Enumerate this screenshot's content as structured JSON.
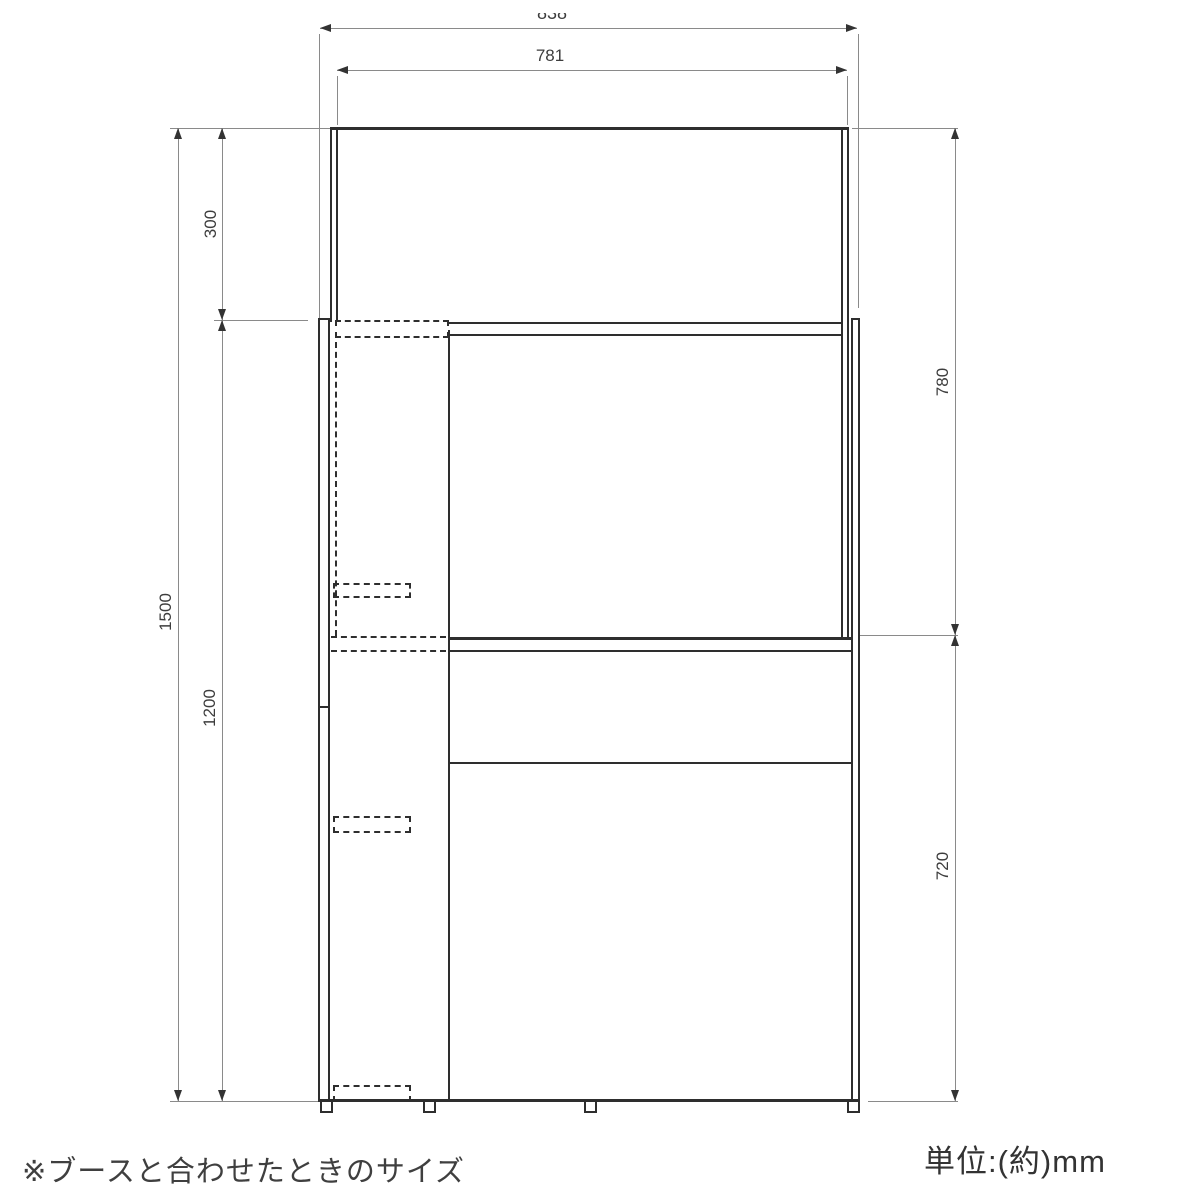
{
  "diagram": {
    "type": "furniture-dimension-drawing",
    "note": "※ブースと合わせたときのサイズ",
    "unit_label": "単位:(約)mm",
    "dimensions": {
      "outer_width": "838",
      "inner_width": "781",
      "top_section_height": "300",
      "total_height": "1500",
      "booth_panel_height": "1200",
      "upper_opening_height": "780",
      "desk_height": "720"
    },
    "colors": {
      "structure_line": "#2e2e2e",
      "dimension_line": "#8a8a8a",
      "label_text": "#3d3d3d"
    }
  }
}
